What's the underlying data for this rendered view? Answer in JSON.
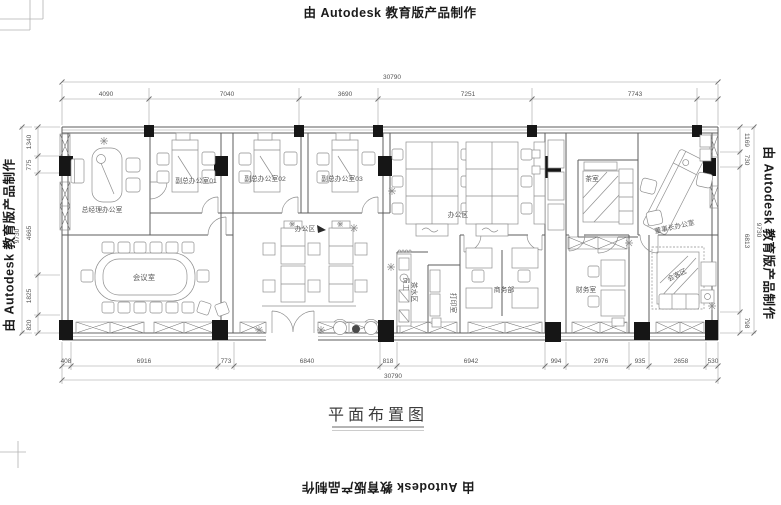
{
  "watermark": {
    "text": "由 Autodesk 教育版产品制作"
  },
  "title": {
    "text": "平面布置图"
  },
  "dimensions": {
    "top": {
      "overall": "30790",
      "segments": [
        "4090",
        "7040",
        "3690",
        "7251",
        "7743"
      ]
    },
    "bottom": {
      "overall": "30790",
      "segments": [
        "408",
        "6916",
        "773",
        "6840",
        "818",
        "6942",
        "994",
        "2976",
        "935",
        "2658",
        "530"
      ]
    },
    "left": {
      "overall": "9730",
      "segments": [
        "1340",
        "775",
        "4665",
        "1825",
        "820"
      ]
    },
    "right": {
      "overall": "9730",
      "segments": [
        "1169",
        "730",
        "6813",
        "798"
      ]
    }
  },
  "rooms": {
    "general_manager": "总经理办公室",
    "deputy1": "副总办公室01",
    "deputy2": "副总办公室02",
    "deputy3": "副总办公室03",
    "lounge_area": "办公区",
    "office_area": "办公区",
    "meeting": "会议室",
    "pantry_line1": "员工",
    "pantry_line2": "茶水区",
    "print_room": "打印室",
    "business": "商务部",
    "finance": "财务室",
    "tea_room": "茶室",
    "chairman": "董事长办公室",
    "guest_area": "会客区"
  },
  "colors": {
    "wall_line": "#5d5d5d",
    "column_fill": "#161616",
    "dim_text": "#555555"
  }
}
